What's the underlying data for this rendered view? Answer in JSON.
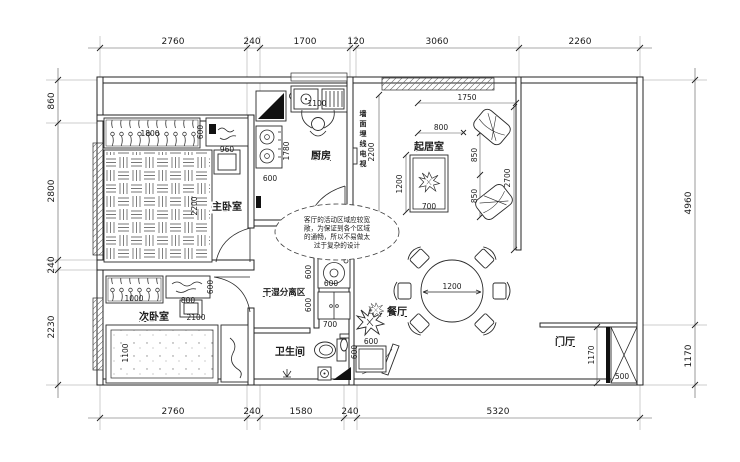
{
  "drawing": {
    "type": "apartment-floor-plan",
    "line_color": "#2a2a2a",
    "wall_color": "#232323",
    "fill_black": "#111111"
  },
  "rooms": {
    "master_bedroom": {
      "label": "主卧室"
    },
    "second_bedroom": {
      "label": "次卧室"
    },
    "kitchen": {
      "label": "厨房"
    },
    "living_room": {
      "label": "起居室"
    },
    "dining_room": {
      "label": "餐厅"
    },
    "bathroom": {
      "label": "卫生间"
    },
    "dry_wet_zone": {
      "label": "干湿分离区"
    },
    "foyer": {
      "label": "门厅"
    }
  },
  "annotations": {
    "tv_wall": "墙面埋线电视",
    "note_line1": "客厅的活动区域应较宽",
    "note_line2": "敞，为保证到各个区域",
    "note_line3": "的通畅，所以不易做太",
    "note_line4": "过于复杂的设计"
  },
  "dims": {
    "top": [
      "2760",
      "240",
      "1700",
      "120",
      "3060",
      "2260"
    ],
    "bottom": [
      "2760",
      "240",
      "1580",
      "240",
      "5320"
    ],
    "left": [
      "860",
      "2800",
      "240",
      "2230"
    ],
    "right": [
      "4960",
      "1170"
    ],
    "master": {
      "wardrobe_w": "1800",
      "wardrobe_d": "600",
      "dresser_w": "960",
      "bed_l": "2200"
    },
    "kitchen": {
      "counter": "1100",
      "depth": "1780",
      "stove_w": "600"
    },
    "tv_wall_h": "2200",
    "living": {
      "sofa_wall": "1750",
      "gap": "800",
      "seat1": "850",
      "seat2": "850",
      "wall": "2700",
      "rug_l": "1200",
      "rug_w": "700"
    },
    "dining": {
      "table_d": "1200",
      "plant": "600"
    },
    "wet": {
      "washer_d": "600",
      "washer_w": "600",
      "cabinet_d": "600",
      "passage": "700"
    },
    "bath": {
      "basin": "600"
    },
    "second": {
      "wardrobe_w": "1000",
      "dresser_w": "800",
      "dresser_d": "600",
      "bed_l": "2100",
      "bed_w": "1100"
    },
    "foyer": {
      "depth": "1170",
      "cabinet_w": "500"
    }
  }
}
